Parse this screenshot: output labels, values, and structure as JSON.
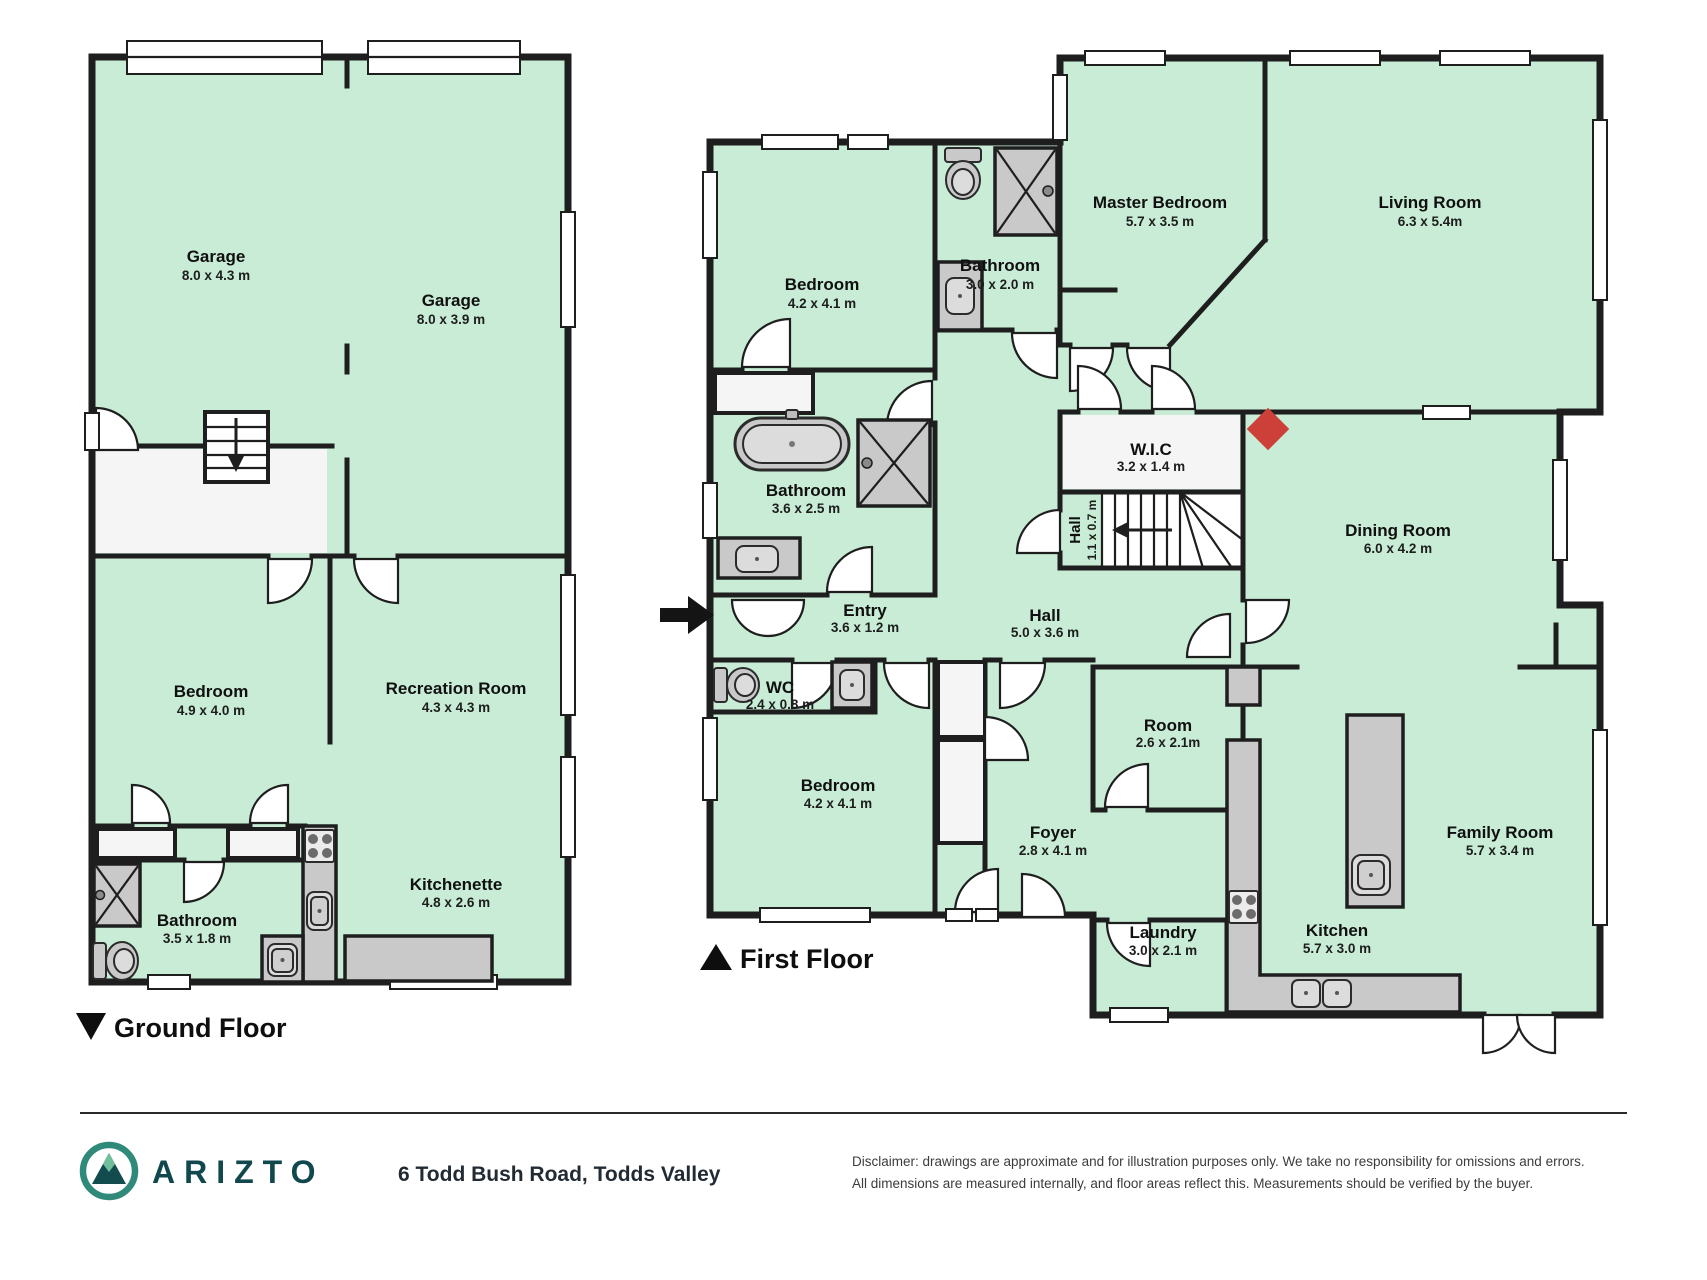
{
  "ground_floor": {
    "label": "Ground Floor",
    "marker": "down-triangle",
    "rooms": [
      {
        "name": "Garage",
        "dims": "8.0 x 4.3 m"
      },
      {
        "name": "Garage",
        "dims": "8.0 x 3.9 m"
      },
      {
        "name": "Bedroom",
        "dims": "4.9 x 4.0 m"
      },
      {
        "name": "Recreation Room",
        "dims": "4.3 x 4.3 m"
      },
      {
        "name": "Bathroom",
        "dims": "3.5 x 1.8 m"
      },
      {
        "name": "Kitchenette",
        "dims": "4.8 x 2.6 m"
      }
    ]
  },
  "first_floor": {
    "label": "First Floor",
    "marker": "up-triangle",
    "rooms": [
      {
        "name": "Bedroom",
        "dims": "4.2 x 4.1 m"
      },
      {
        "name": "Bathroom",
        "dims": "3.0 x 2.0 m"
      },
      {
        "name": "Master Bedroom",
        "dims": "5.7 x 3.5 m"
      },
      {
        "name": "Living Room",
        "dims": "6.3 x 5.4m"
      },
      {
        "name": "Bathroom",
        "dims": "3.6 x 2.5 m"
      },
      {
        "name": "W.I.C",
        "dims": "3.2 x 1.4 m"
      },
      {
        "name": "Hall",
        "dims": "1.1 x 0.7 m"
      },
      {
        "name": "Dining Room",
        "dims": "6.0 x 4.2 m"
      },
      {
        "name": "Entry",
        "dims": "3.6 x 1.2 m"
      },
      {
        "name": "Hall",
        "dims": "5.0 x 3.6 m"
      },
      {
        "name": "WC",
        "dims": "2.4 x 0.8 m"
      },
      {
        "name": "Bedroom",
        "dims": "4.2 x 4.1 m"
      },
      {
        "name": "Room",
        "dims": "2.6 x 2.1m"
      },
      {
        "name": "Foyer",
        "dims": "2.8 x 4.1 m"
      },
      {
        "name": "Family Room",
        "dims": "5.7 x 3.4 m"
      },
      {
        "name": "Laundry",
        "dims": "3.0 x 2.1 m"
      },
      {
        "name": "Kitchen",
        "dims": "5.7 x 3.0 m"
      }
    ]
  },
  "footer": {
    "brand": "ARIZTO",
    "address": "6 Todd Bush Road, Todds Valley",
    "disclaimer_line1": "Disclaimer: drawings are approximate and for illustration purposes only. We take no responsibility for omissions and errors.",
    "disclaimer_line2": "All dimensions are measured internally, and floor areas reflect this. Measurements should be verified by the buyer."
  },
  "colors": {
    "floor_fill": "#c8ecd5",
    "wall": "#1e1e1e",
    "fixture_gray": "#c9c9c9",
    "accent_red": "#cd3f39",
    "brand_teal": "#10484d"
  }
}
